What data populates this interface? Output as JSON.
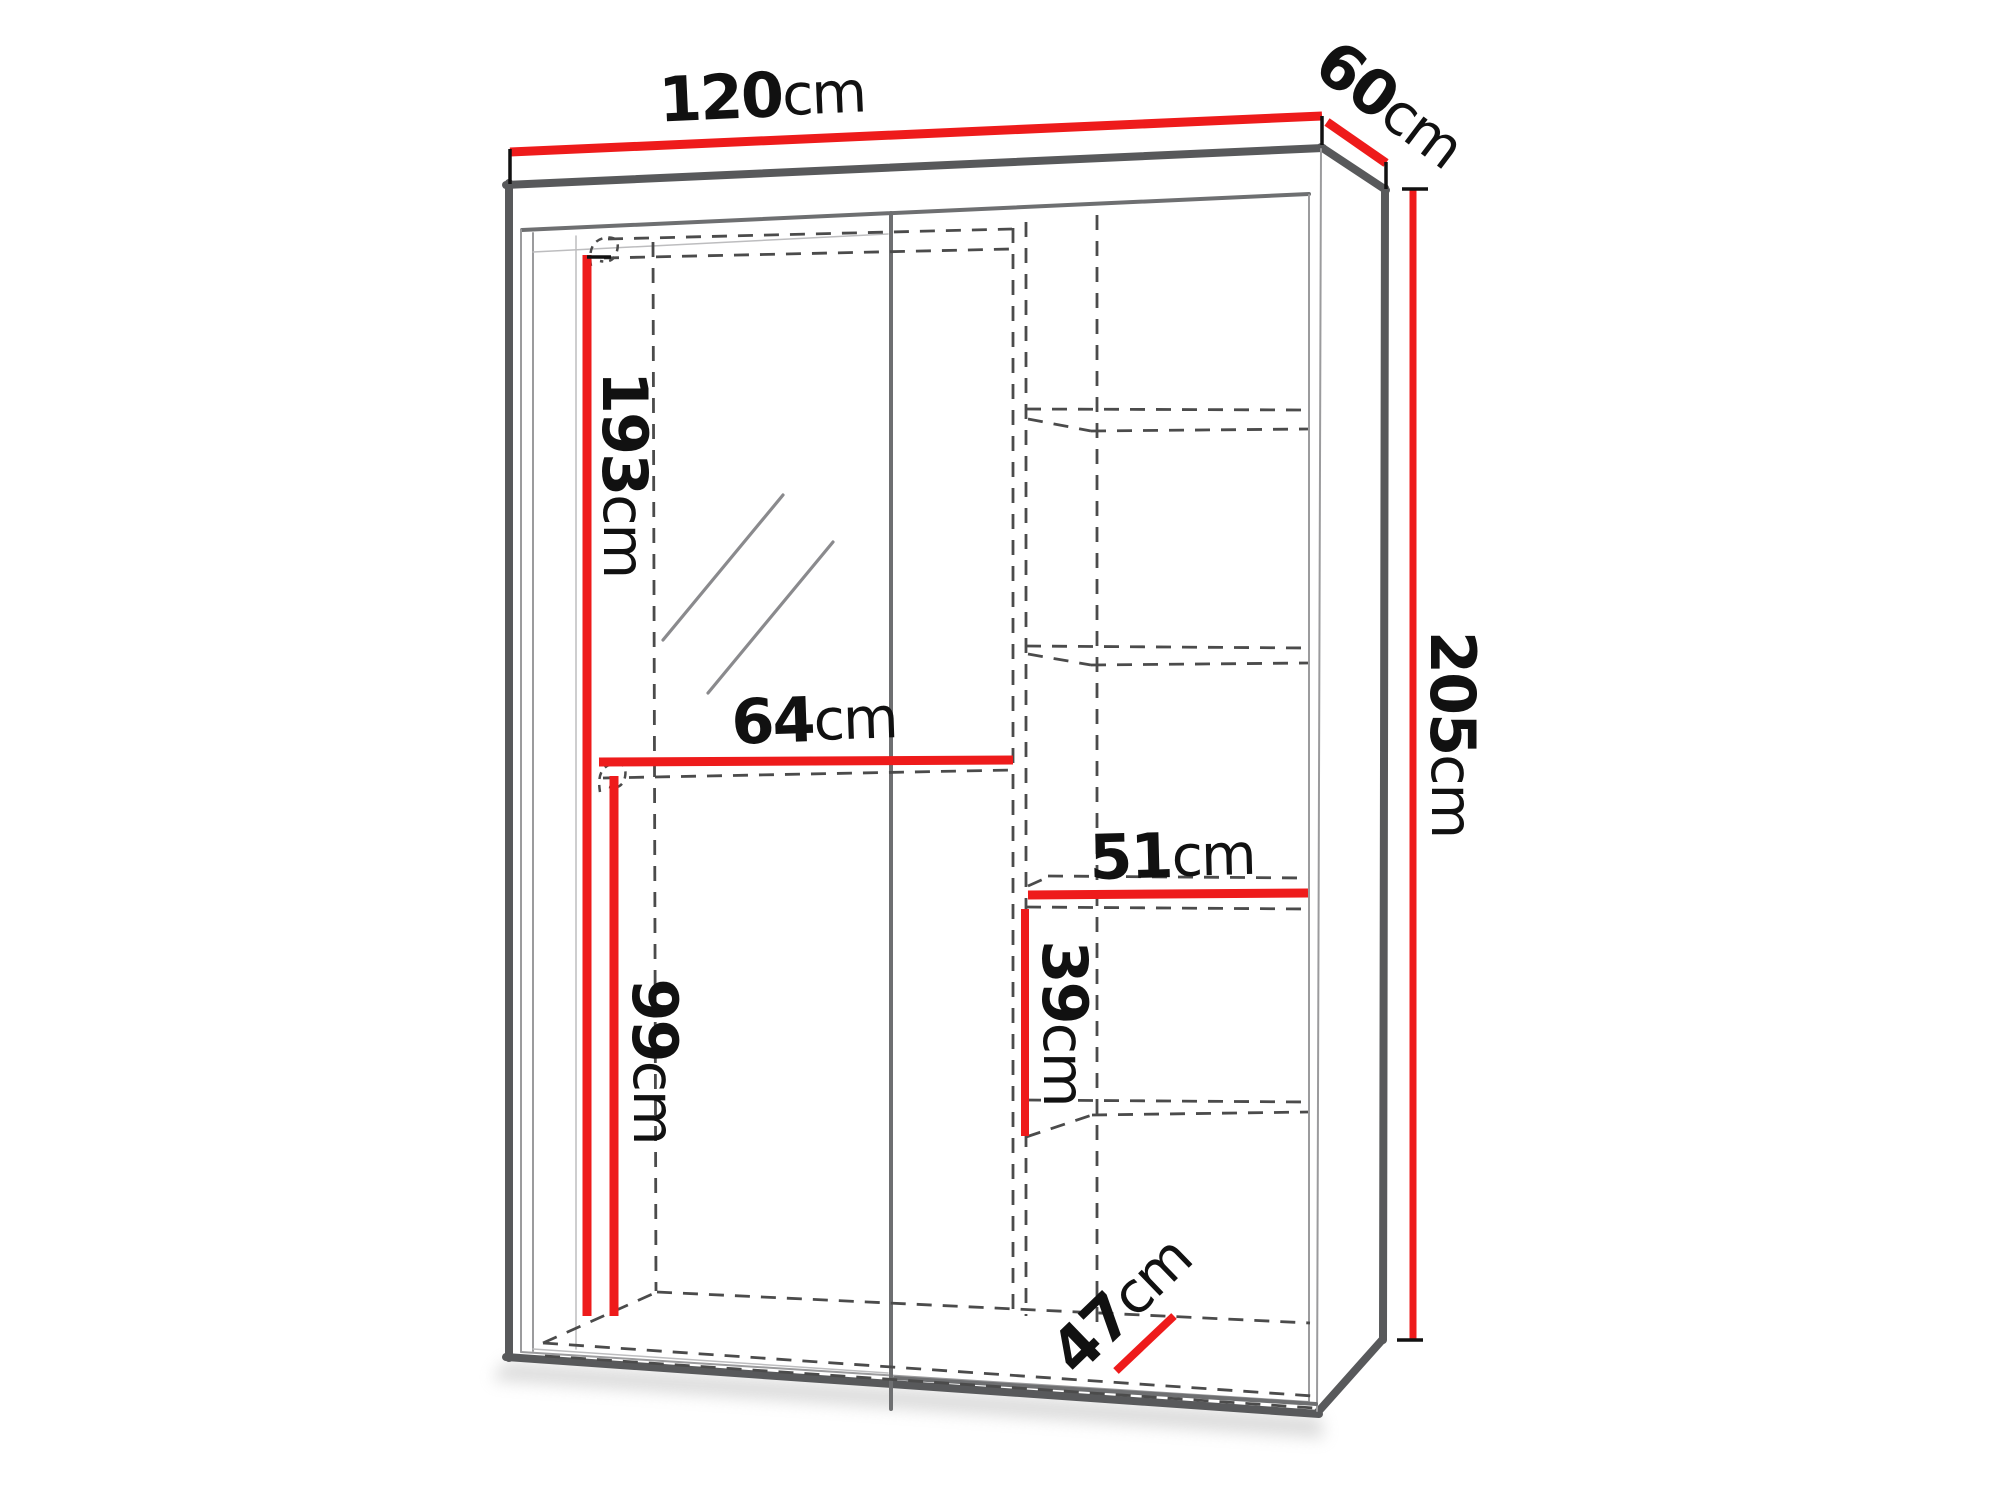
{
  "diagram": {
    "title": "wardrobe-dimension-diagram",
    "product": "two-door sliding wardrobe with mirror and side shelves",
    "unit": "cm",
    "colors": {
      "dimension_line": "#ee1b1b",
      "outline": "#58595b",
      "hidden_edge_dash": "#4b4b4b",
      "label_text": "#111111",
      "background": "#ffffff"
    },
    "dimensions": [
      {
        "id": "overall-width",
        "value": "120",
        "unit": "cm"
      },
      {
        "id": "overall-depth",
        "value": "60",
        "unit": "cm"
      },
      {
        "id": "overall-height",
        "value": "205",
        "unit": "cm"
      },
      {
        "id": "hanging-height",
        "value": "193",
        "unit": "cm"
      },
      {
        "id": "rail-width",
        "value": "64",
        "unit": "cm"
      },
      {
        "id": "shelf-width",
        "value": "51",
        "unit": "cm"
      },
      {
        "id": "shelf-spacing",
        "value": "39",
        "unit": "cm"
      },
      {
        "id": "lower-height",
        "value": "99",
        "unit": "cm"
      },
      {
        "id": "interior-depth",
        "value": "47",
        "unit": "cm"
      }
    ]
  }
}
